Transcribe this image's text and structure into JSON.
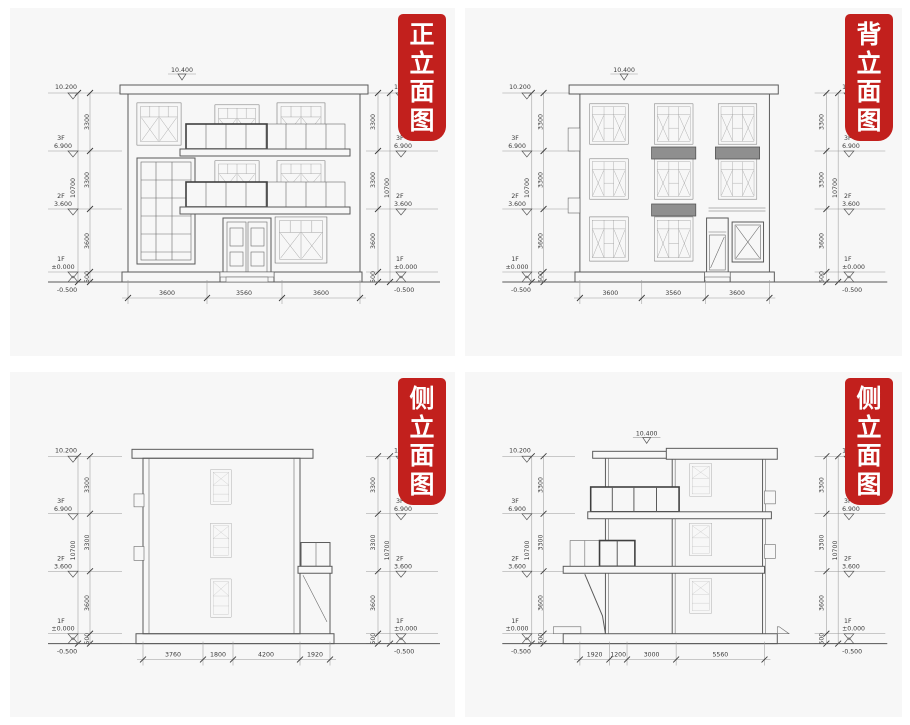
{
  "page": {
    "background": "#ffffff",
    "panel_background": "#f7f7f7",
    "line_color": "#5a5a5a",
    "dim_line_color": "#9a9a9a",
    "stamp": {
      "background": "#c2201d",
      "text_color": "#ffffff"
    }
  },
  "levels": {
    "roof_top": "10.200",
    "floor3_label": "3F",
    "floor3_elev": "6.900",
    "floor2_label": "2F",
    "floor2_elev": "3.600",
    "floor1_label": "1F",
    "floor1_elev": "±0.000",
    "ground_elev": "-0.500",
    "dim_f3": "3300",
    "dim_f2": "3300",
    "dim_f1": "3600",
    "dim_plinth": "500",
    "dim_total": "10700"
  },
  "panels": [
    {
      "id": "front-elevation",
      "title": "正立面图",
      "chars": [
        "正",
        "立",
        "面",
        "图"
      ],
      "roof_mark": "10.400",
      "bottom_dims": [
        "3600",
        "3560",
        "3600"
      ]
    },
    {
      "id": "back-elevation",
      "title": "背立面图",
      "chars": [
        "背",
        "立",
        "面",
        "图"
      ],
      "roof_mark": "10.400",
      "bottom_dims": [
        "3600",
        "3560",
        "3600"
      ]
    },
    {
      "id": "side-elevation-left",
      "title": "侧立面图",
      "chars": [
        "侧",
        "立",
        "面",
        "图"
      ],
      "bottom_dims": [
        "3760",
        "1800",
        "4200",
        "1920"
      ]
    },
    {
      "id": "side-elevation-right",
      "title": "侧立面图",
      "chars": [
        "侧",
        "立",
        "面",
        "图"
      ],
      "roof_mark": "10.400",
      "bottom_dims": [
        "1920",
        "1200",
        "3000",
        "5560"
      ]
    }
  ]
}
